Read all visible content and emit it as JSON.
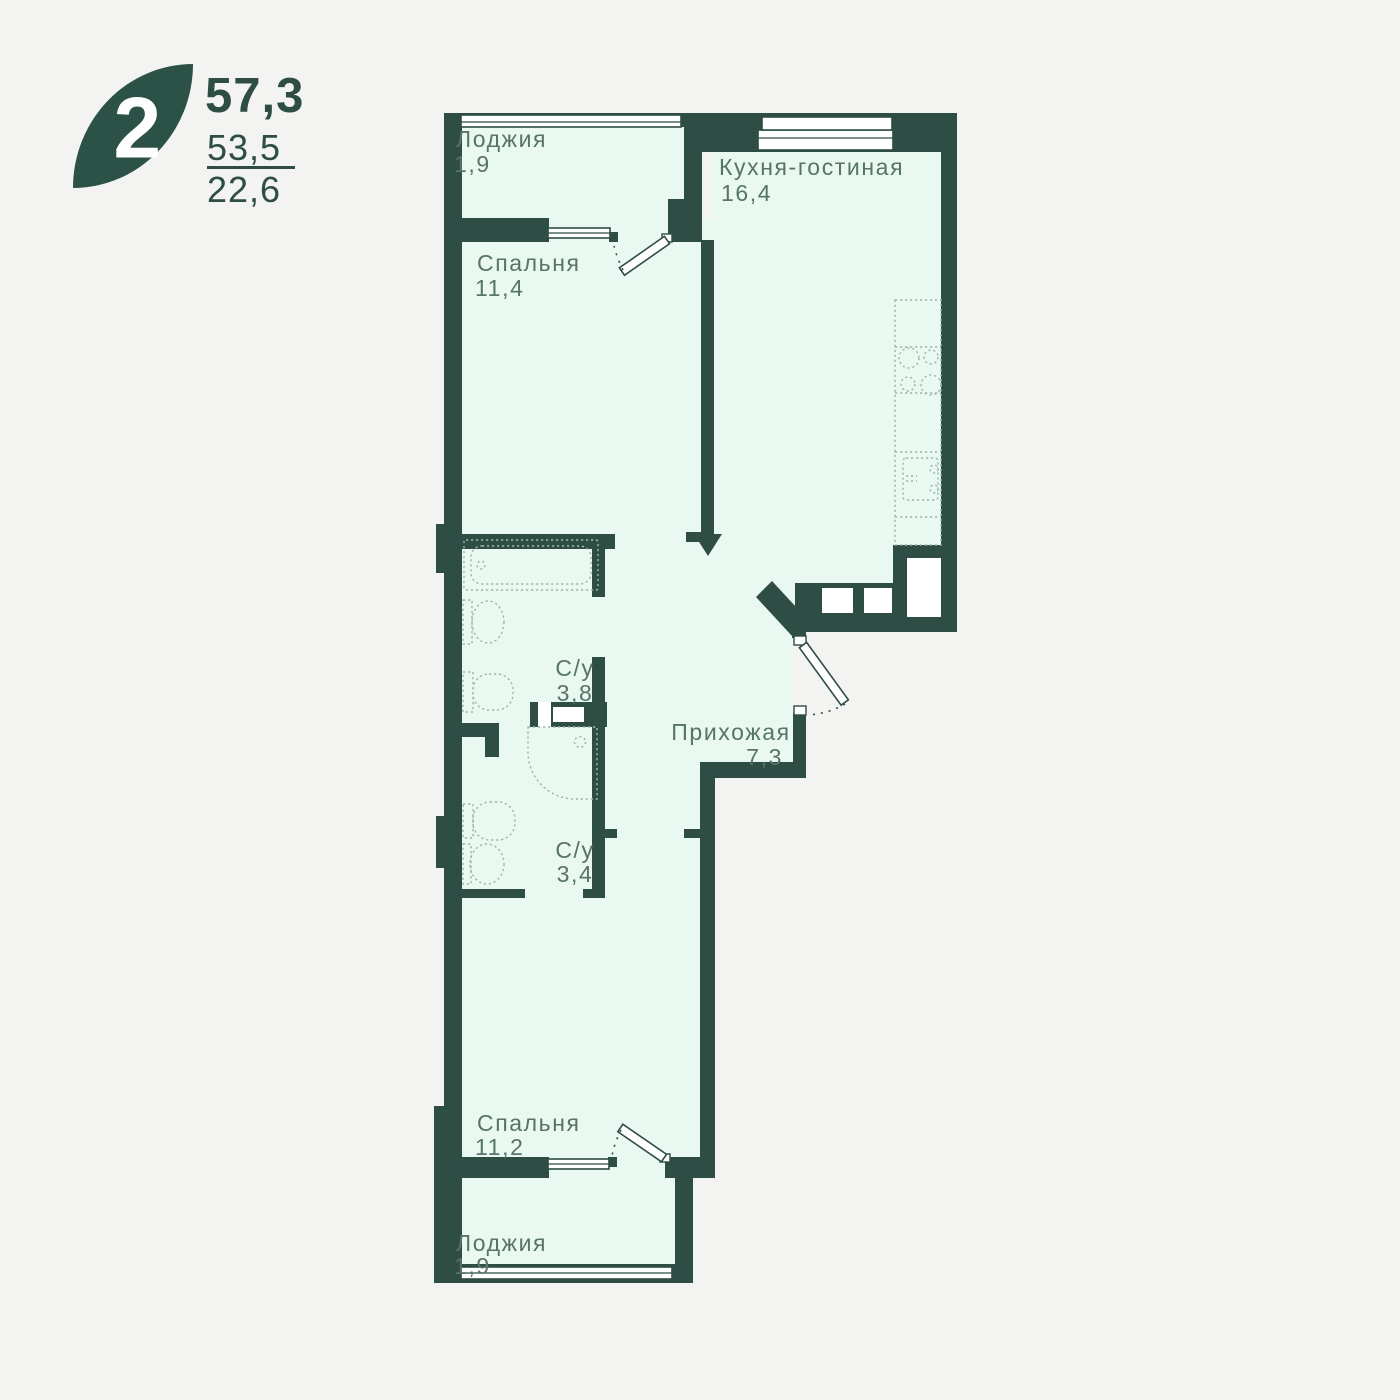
{
  "badge": {
    "rooms_count": "2",
    "area_total": "57,3",
    "area_secondary": "53,5",
    "area_tertiary": "22,6"
  },
  "rooms": [
    {
      "key": "loggia-top",
      "name": "Лоджия",
      "area": "1,9"
    },
    {
      "key": "bedroom-top",
      "name": "Спальня",
      "area": "11,4"
    },
    {
      "key": "kitchen-living",
      "name": "Кухня-гостиная",
      "area": "16,4"
    },
    {
      "key": "bathroom-top",
      "name": "С/у",
      "area": "3,8"
    },
    {
      "key": "hallway",
      "name": "Прихожая",
      "area": "7,3"
    },
    {
      "key": "bathroom-bottom",
      "name": "С/у",
      "area": "3,4"
    },
    {
      "key": "bedroom-bottom",
      "name": "Спальня",
      "area": "11,2"
    },
    {
      "key": "loggia-bottom",
      "name": "Лоджия",
      "area": "1,9"
    }
  ],
  "colors": {
    "wall": "#2e4d45",
    "interior": "#e9f8f1",
    "background": "#f3f4f2",
    "label_text": "#567468",
    "logo_leaf": "#2c5147",
    "fixture_dash": "#9eb5aa",
    "window_white": "#ffffff"
  }
}
